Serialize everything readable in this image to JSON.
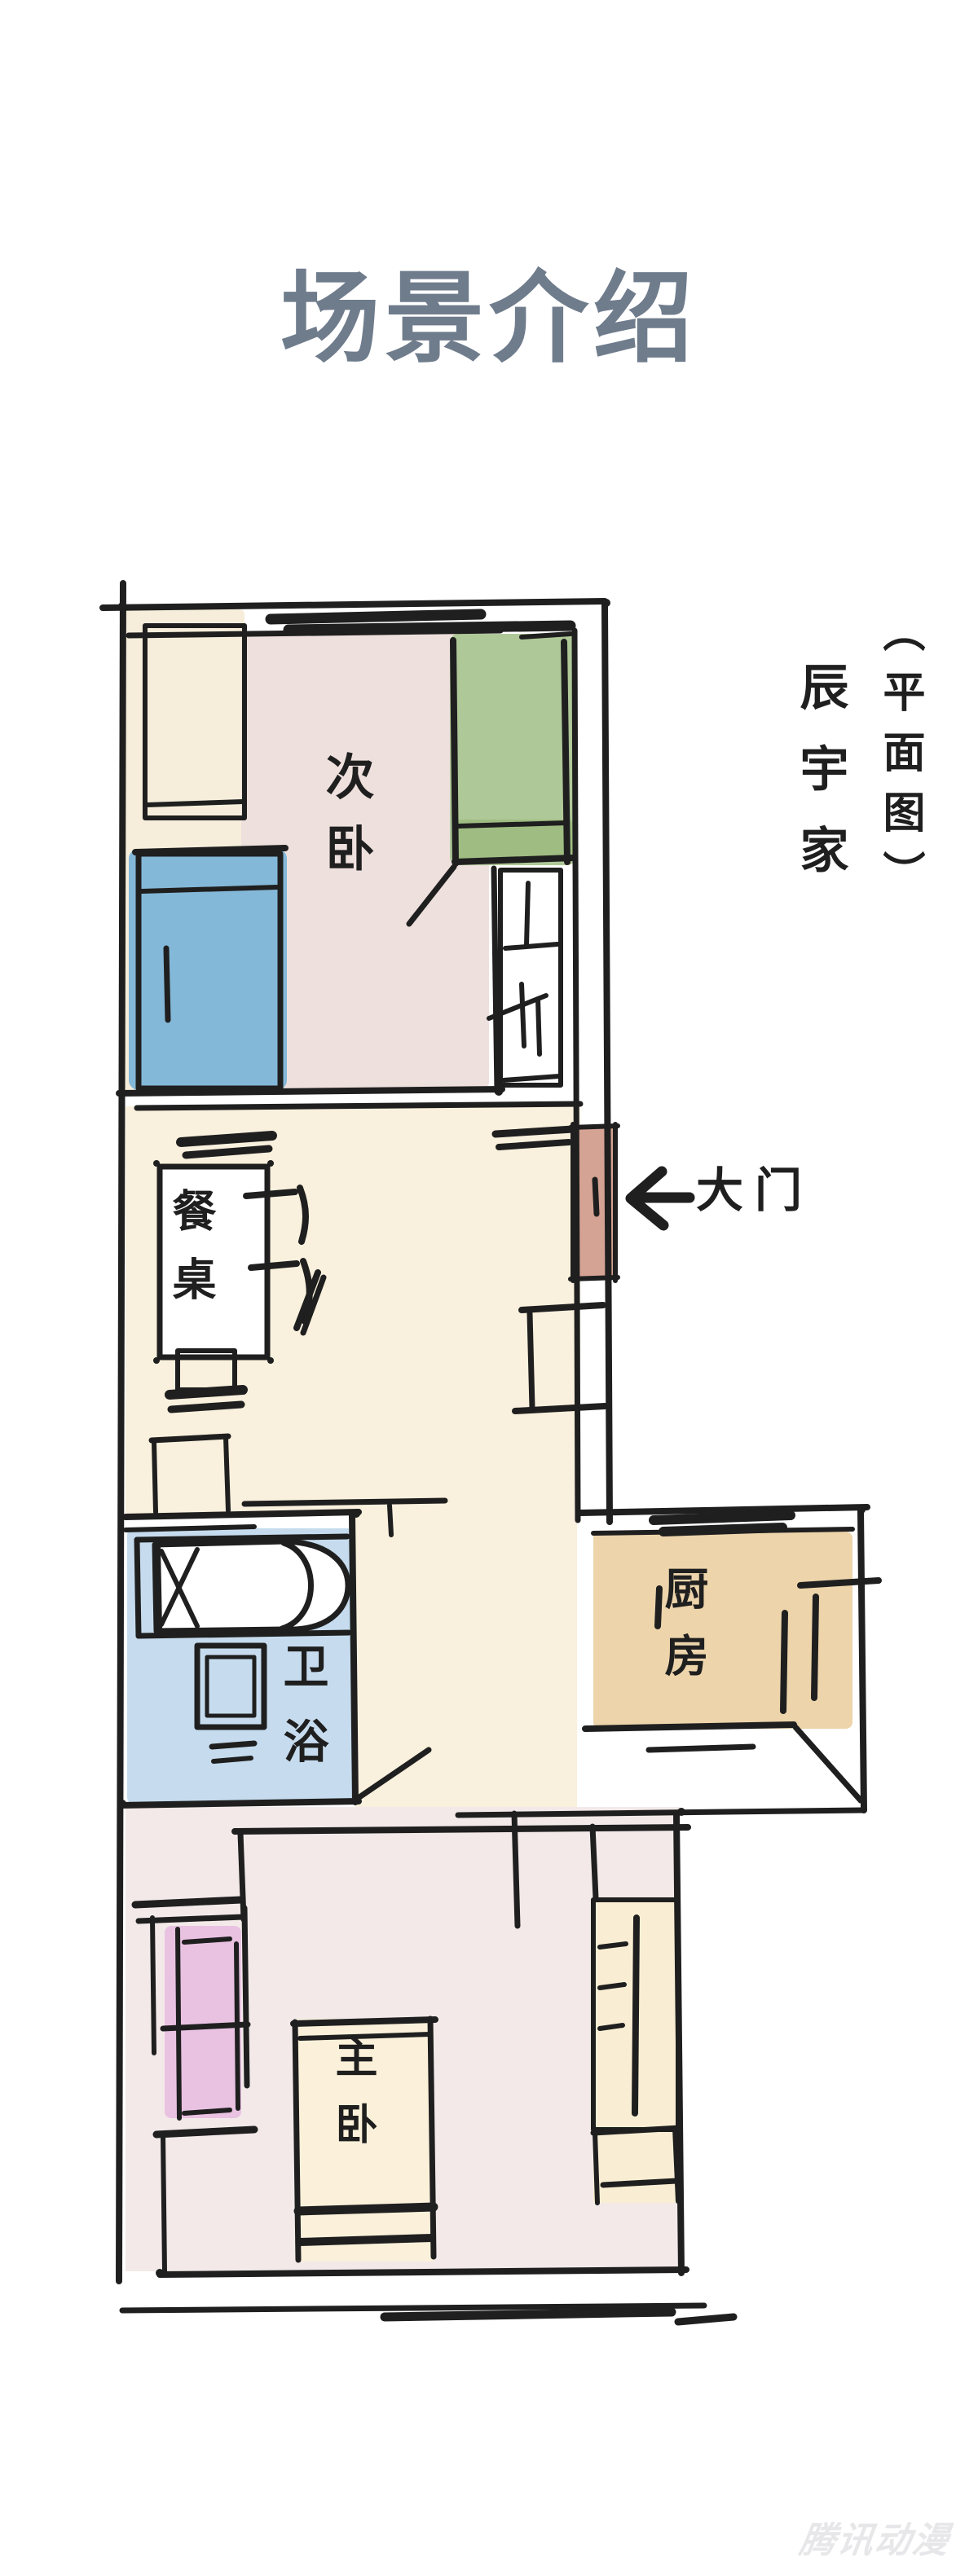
{
  "title": {
    "text": "场景介绍",
    "color": "#6f7c8c"
  },
  "caption": {
    "name": "辰宇家",
    "suffix": "（平面图）"
  },
  "rooms": {
    "secondary_bedroom": "次卧",
    "dining_table": "餐桌",
    "bathroom": "卫浴",
    "kitchen": "厨房",
    "master_bedroom": "主卧",
    "main_door": "大门"
  },
  "icons": {
    "door_arrow": "←"
  },
  "palette": {
    "wall": "#1f1f1f",
    "secondary_floor": "#eee0dd",
    "secondary_side_floor": "#f6eedb",
    "green_bed": "#afc898",
    "green_bed_band": "#9fbc82",
    "blue_bed": "#84b8d8",
    "living_floor": "#f9f0dd",
    "bathroom_floor": "#c6dcee",
    "kitchen_floor": "#edd4ab",
    "door_panel": "#d5a393",
    "master_floor": "#f3e9e9",
    "master_bed": "#fbf1da",
    "dresser": "#e9c2e2",
    "closet": "#f9eed3"
  },
  "watermark": {
    "text": "腾讯动漫",
    "color": "#e7e7e9"
  }
}
